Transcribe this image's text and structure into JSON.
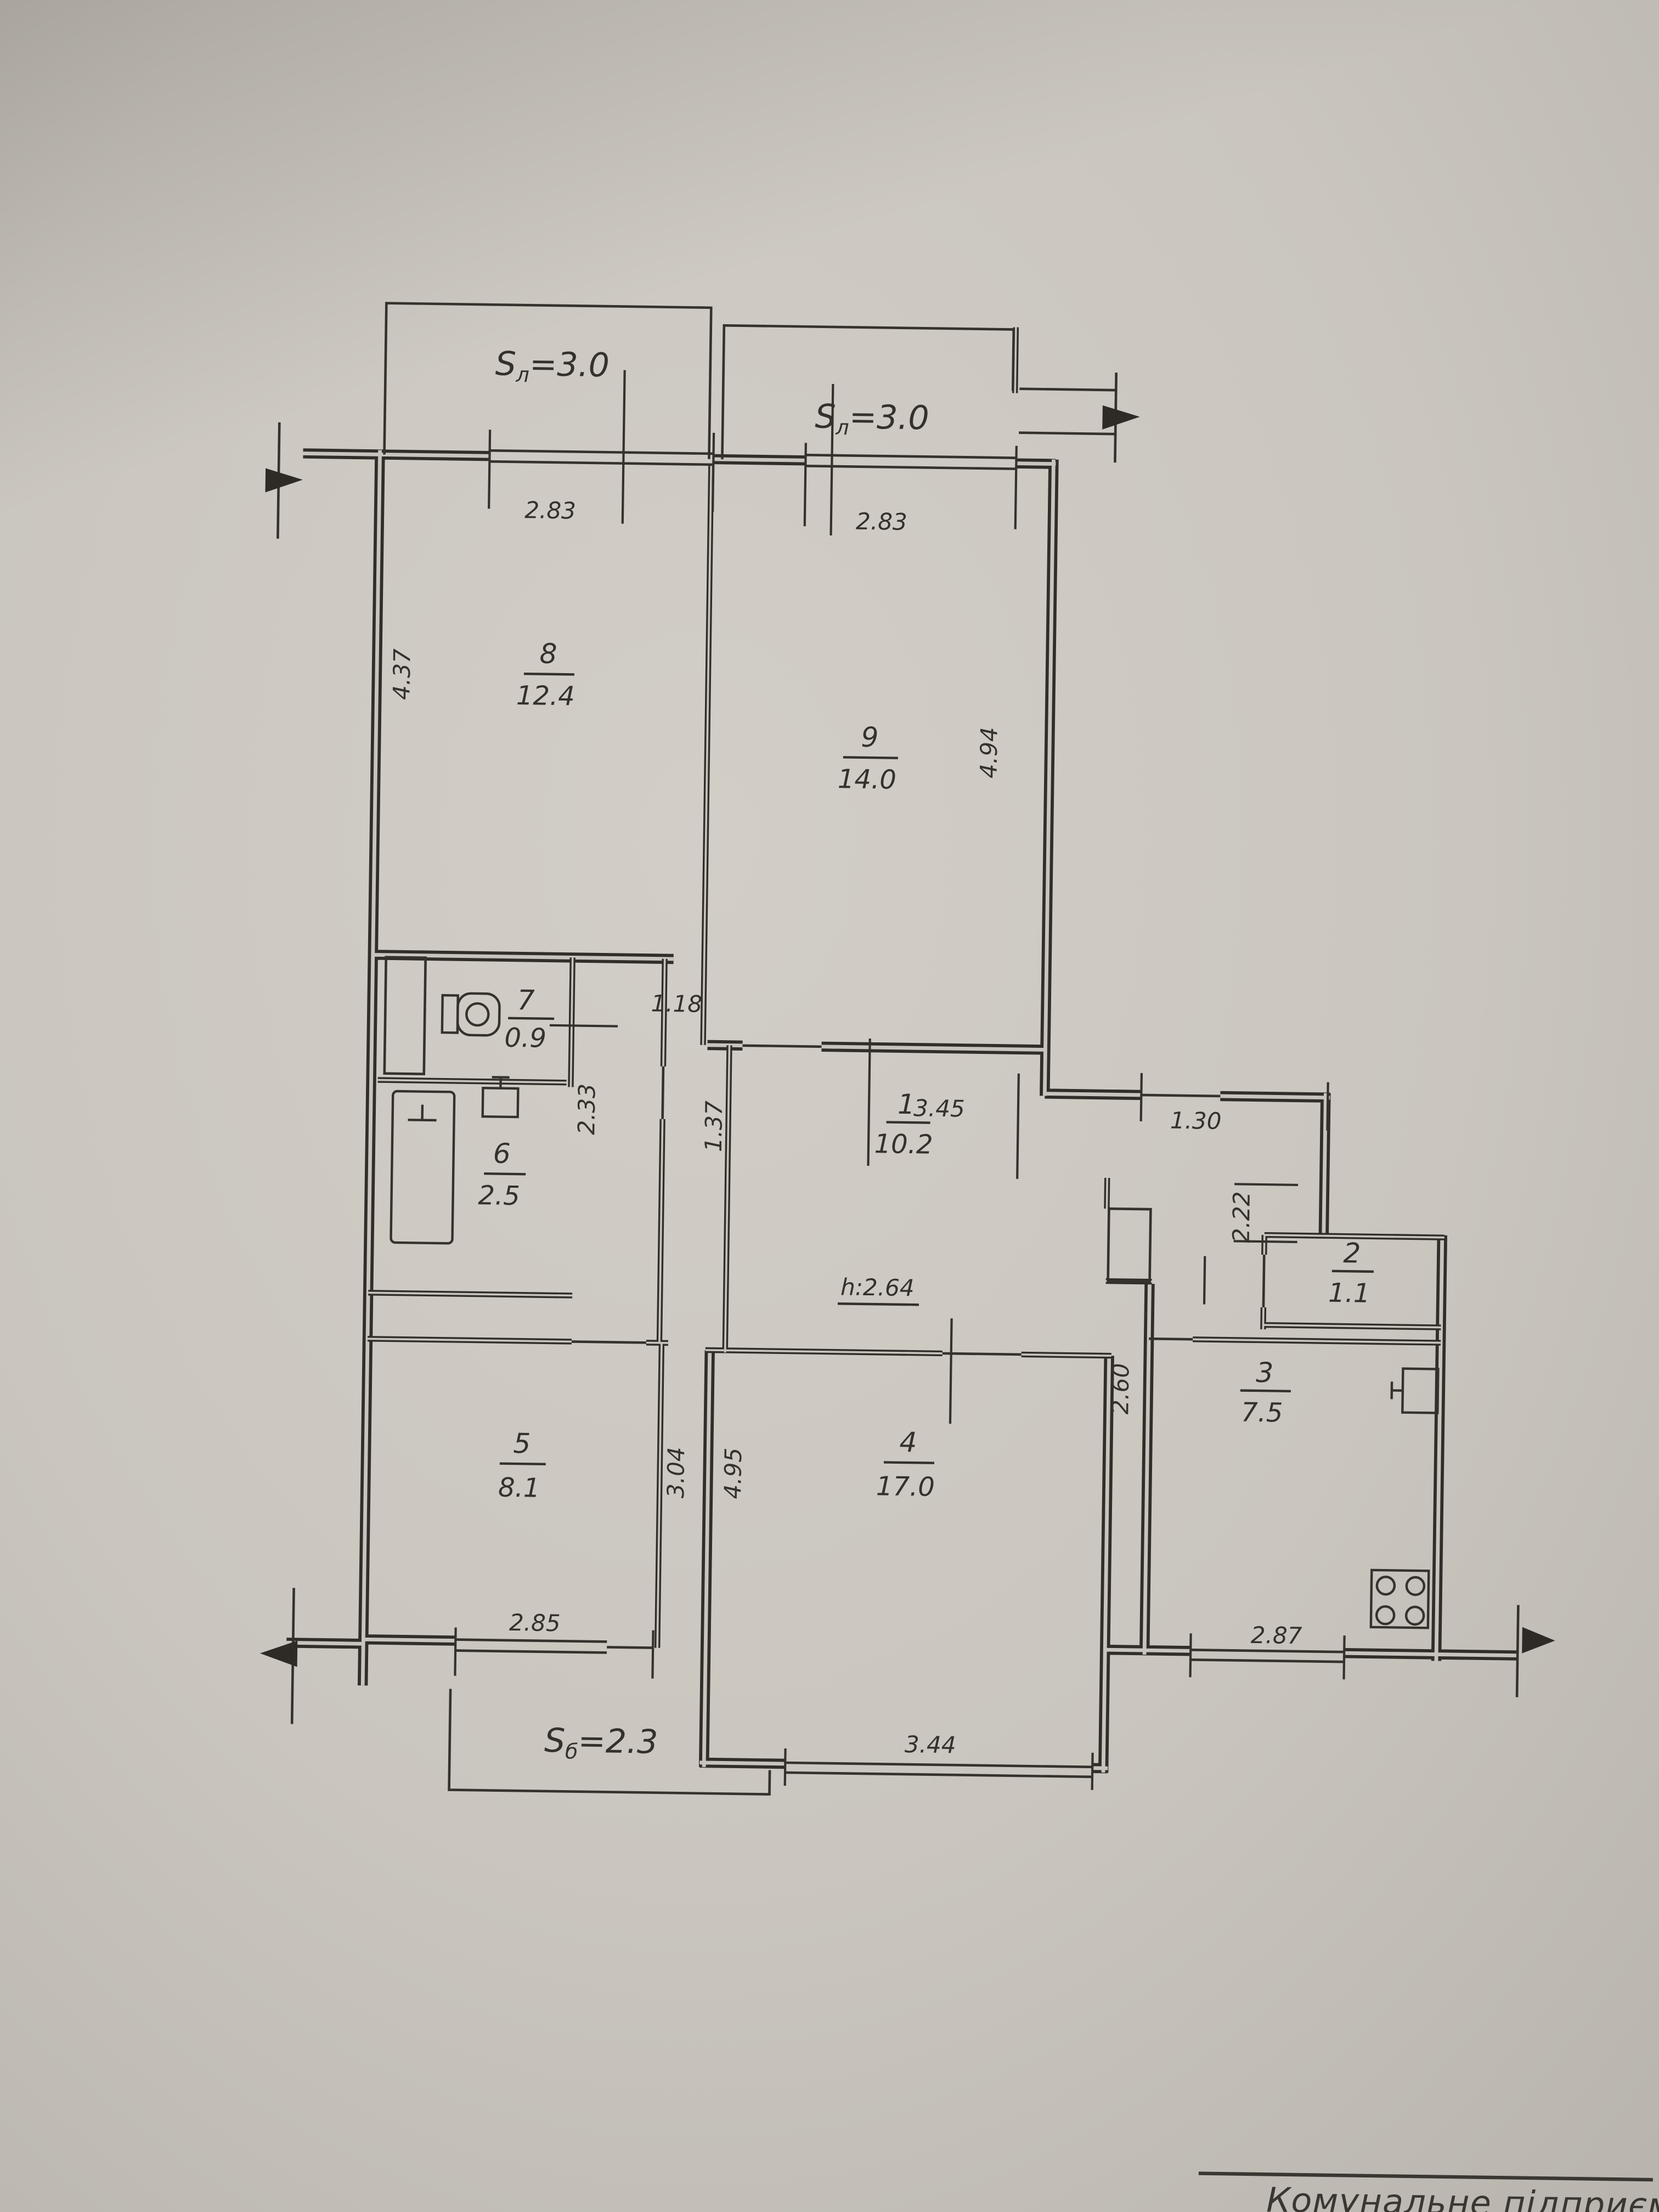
{
  "photo": {
    "bottom_note": "Комунальне підприємс",
    "paper_color": "#c8c4bd",
    "line_color": "#312e2a"
  },
  "plan": {
    "height_note": "h:2.64",
    "balconies": {
      "top_left": {
        "s": "S",
        "sub": "л",
        "val": "=3.0",
        "dim": "2.83"
      },
      "top_right": {
        "s": "S",
        "sub": "л",
        "val": "=3.0",
        "dim": "2.83"
      },
      "bottom": {
        "s": "S",
        "sub": "б",
        "val": "=2.3",
        "dim": "2.85"
      }
    },
    "rooms": {
      "r1": {
        "num": "1",
        "area": "10.2"
      },
      "r2": {
        "num": "2",
        "area": "1.1"
      },
      "r3": {
        "num": "3",
        "area": "7.5"
      },
      "r4": {
        "num": "4",
        "area": "17.0"
      },
      "r5": {
        "num": "5",
        "area": "8.1"
      },
      "r6": {
        "num": "6",
        "area": "2.5"
      },
      "r7": {
        "num": "7",
        "area": "0.9"
      },
      "r8": {
        "num": "8",
        "area": "12.4"
      },
      "r9": {
        "num": "9",
        "area": "14.0"
      }
    },
    "dims": {
      "room8_height": "4.37",
      "room9_height": "4.94",
      "nook": "1.18",
      "closet_height": "2.33",
      "hall_top": "3.45",
      "hall_right": "1.30",
      "hall_left_height": "1.37",
      "corridor_height": "2.22",
      "kitchen_left_height": "2.60",
      "kitchen_bottom": "2.87",
      "room5_height": "3.04",
      "room4_height": "4.95",
      "room4_window": "3.44"
    }
  }
}
